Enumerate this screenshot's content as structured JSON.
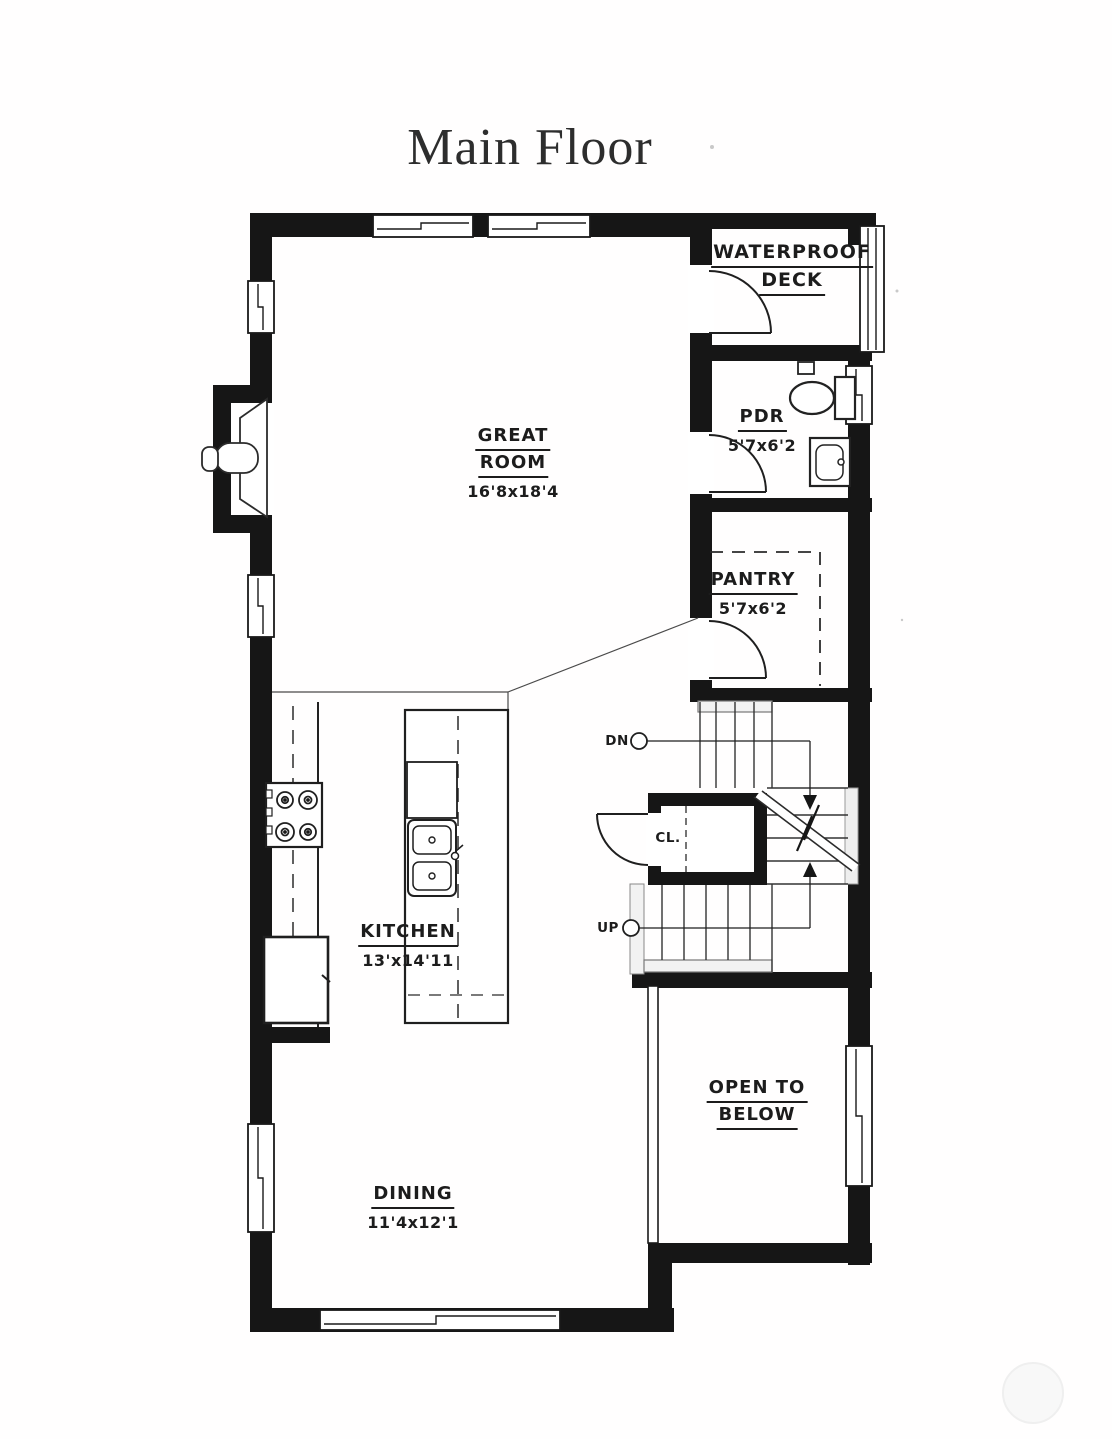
{
  "title": "Main Floor",
  "rooms": {
    "deck": {
      "line1": "WATERPROOF",
      "line2": "DECK"
    },
    "great_room": {
      "line1": "GREAT",
      "line2": "ROOM",
      "dims": "16'8x18'4"
    },
    "pdr": {
      "name": "PDR",
      "dims": "5'7x6'2"
    },
    "pantry": {
      "name": "PANTRY",
      "dims": "5'7x6'2"
    },
    "kitchen": {
      "name": "KITCHEN",
      "dims": "13'x14'11"
    },
    "dining": {
      "name": "DINING",
      "dims": "11'4x12'1"
    },
    "open_to_below": {
      "line1": "OPEN TO",
      "line2": "BELOW"
    }
  },
  "stairs": {
    "down": "DN",
    "up": "UP",
    "closet": "CL."
  },
  "colors": {
    "wall": "#161616",
    "line": "#2b2b2b",
    "paper": "#ffffff"
  }
}
